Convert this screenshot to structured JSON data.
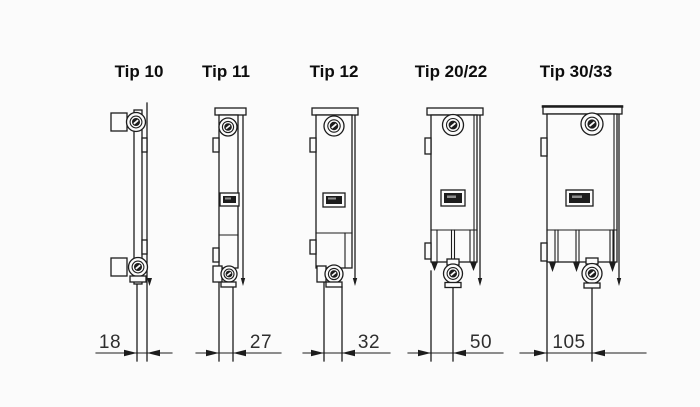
{
  "diagram": {
    "types": [
      {
        "label": "Tip 10",
        "depth": "18"
      },
      {
        "label": "Tip 11",
        "depth": "27"
      },
      {
        "label": "Tip 12",
        "depth": "32"
      },
      {
        "label": "Tip 20/22",
        "depth": "50"
      },
      {
        "label": "Tip 30/33",
        "depth": "105"
      }
    ],
    "colors": {
      "line": "#1c1c1c",
      "background": "#fbfbfb"
    }
  }
}
